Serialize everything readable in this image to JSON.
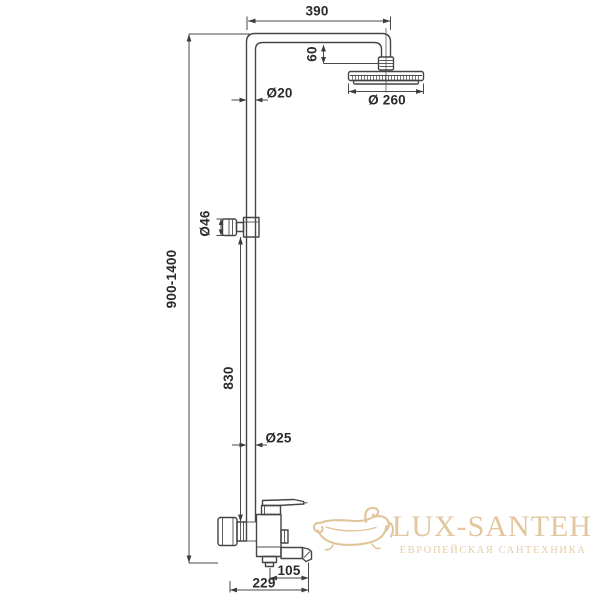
{
  "page": {
    "background_color": "#ffffff"
  },
  "drawing": {
    "kind": "shower-column-technical-drawing",
    "line_color": "#454545",
    "text_color": "#2b2b2b",
    "dimensions": {
      "top_arm_width": "390",
      "head_offset": "60",
      "upper_pipe_diameter": "Ø20",
      "shower_head_diameter": "Ø 260",
      "slider_knob_diameter": "Ø46",
      "total_height_range": "900-1400",
      "slide_bar_length": "830",
      "lower_pipe_diameter": "Ø25",
      "spout_reach": "105",
      "base_width": "229"
    }
  },
  "watermark": {
    "brand": "LUX-SANTEH",
    "tagline": "ЕВРОПЕЙСКАЯ САНТЕХНИКА",
    "brand_color": "#e2c69e",
    "tagline_color": "#e6cda9",
    "icon": "bathtub-icon",
    "icon_color": "#dfc197"
  }
}
